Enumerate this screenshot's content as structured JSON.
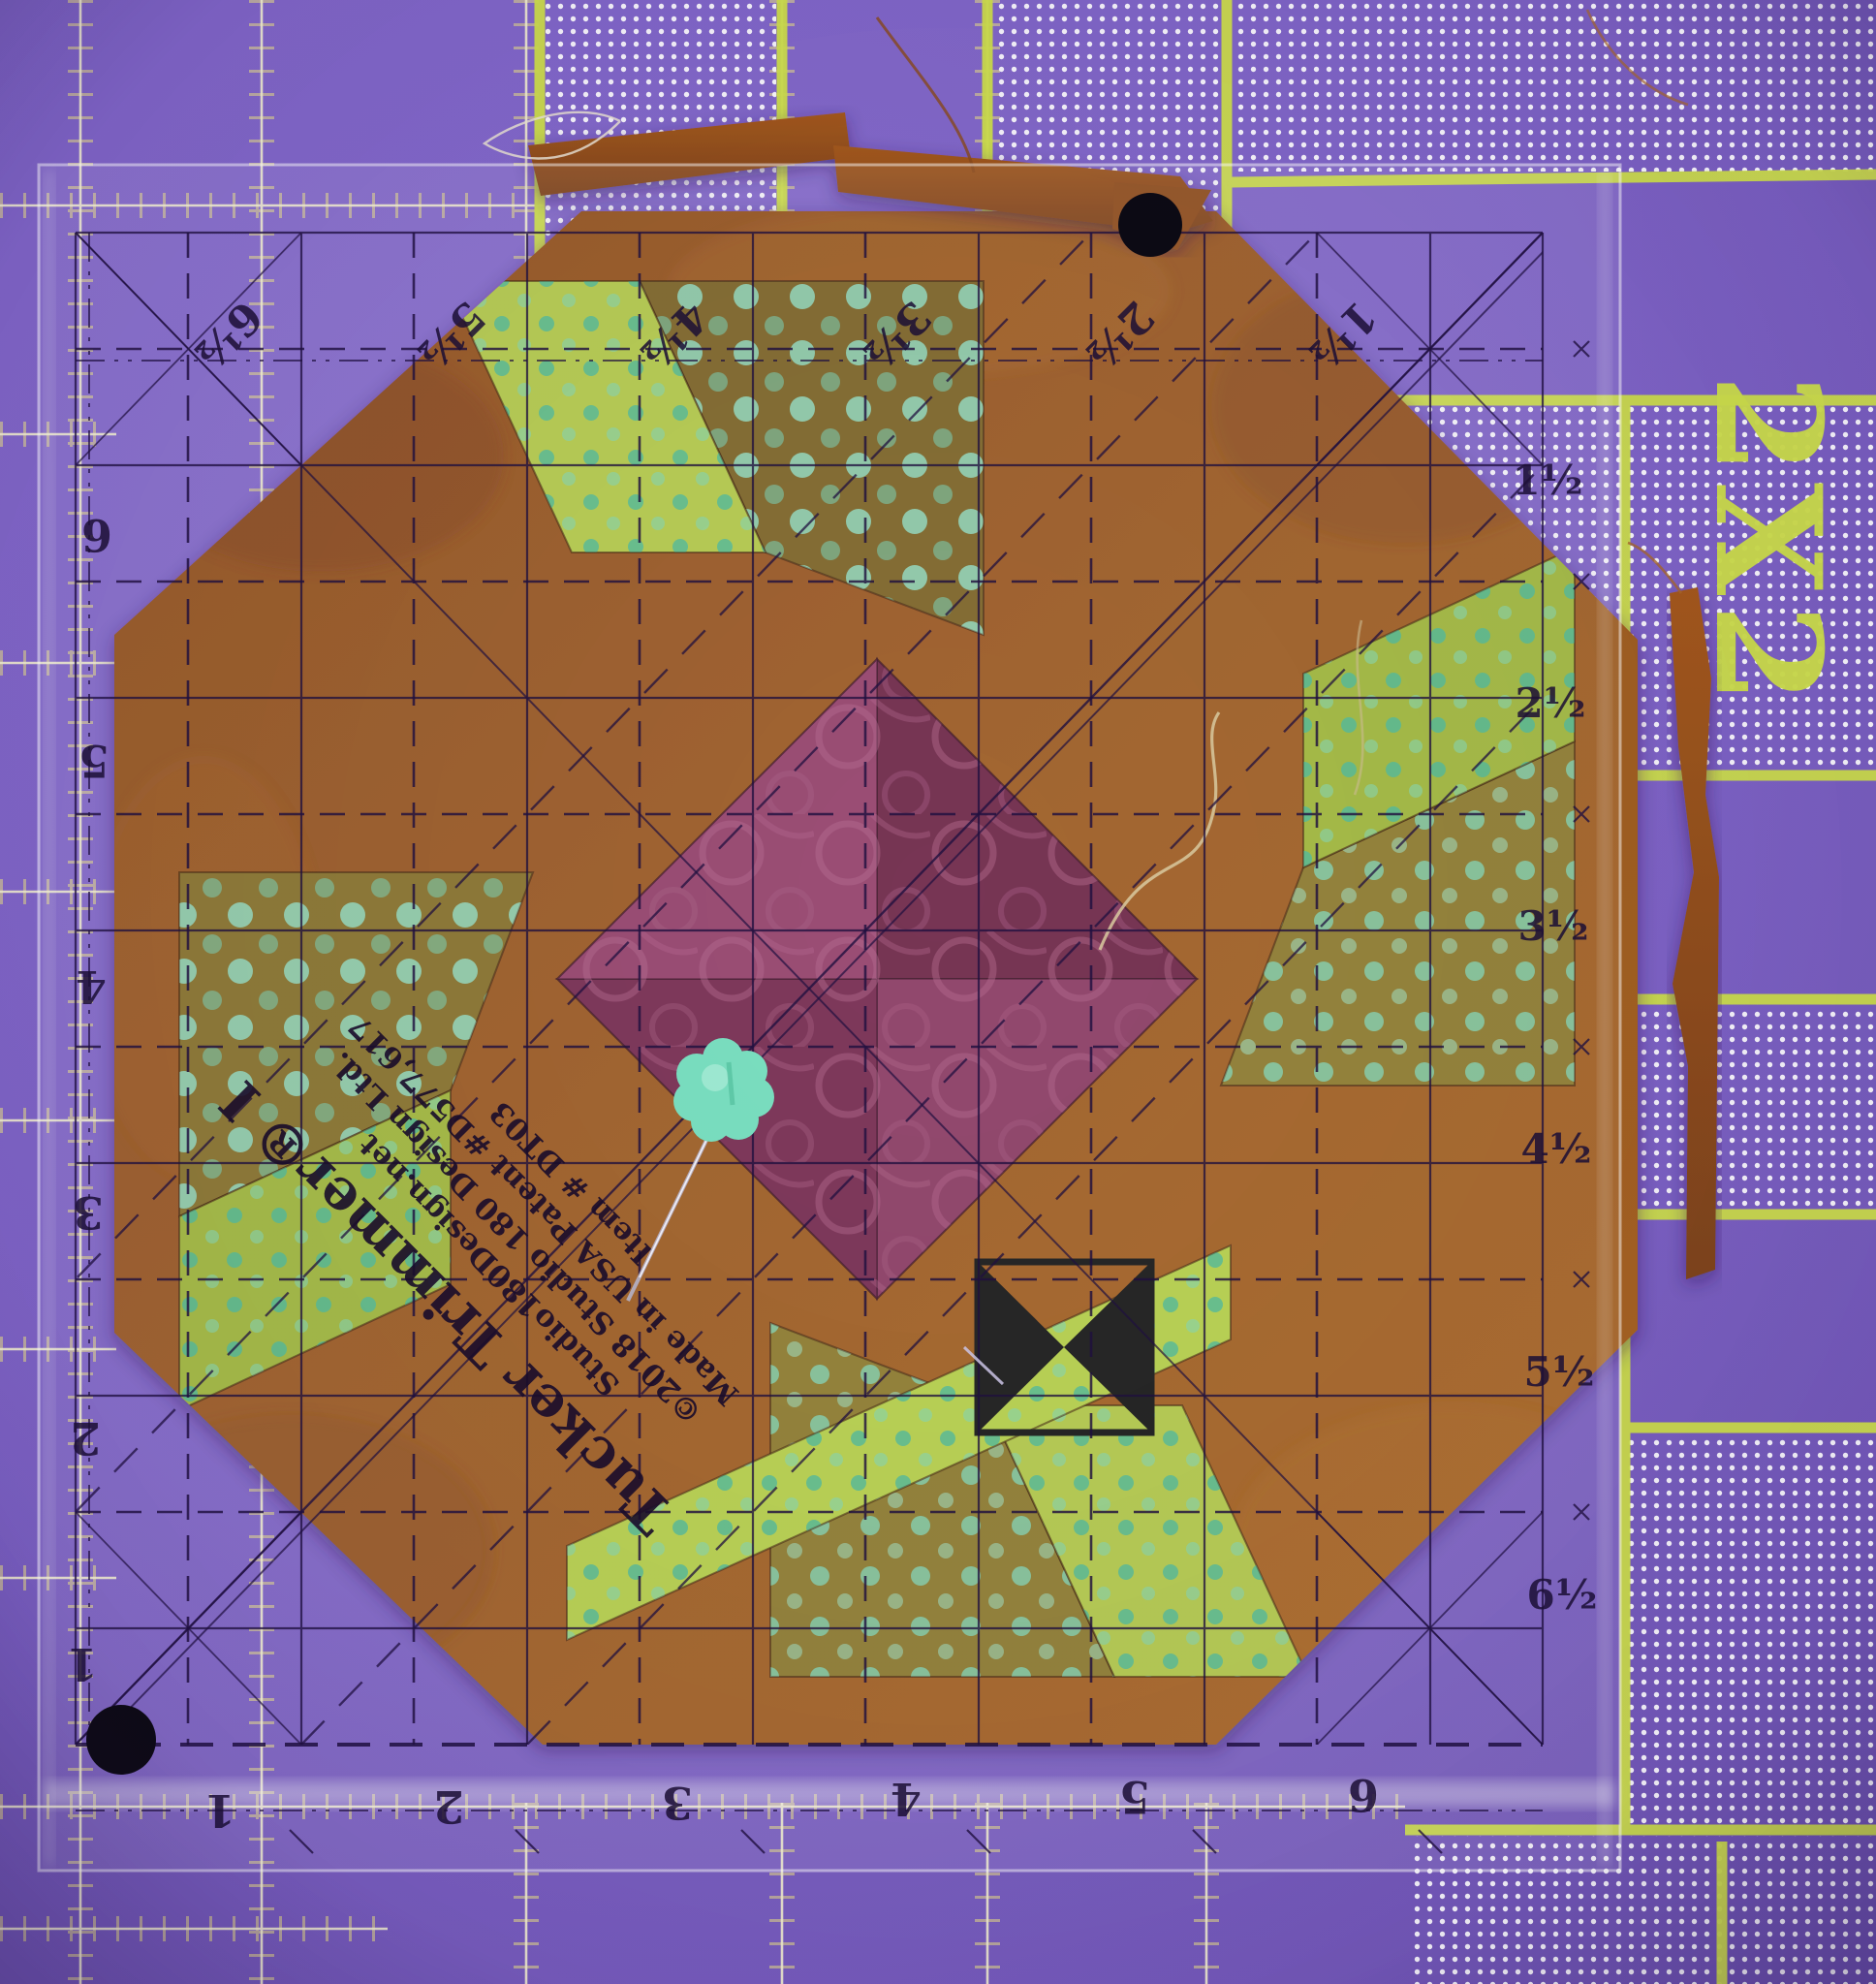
{
  "mat": {
    "label_2x2": "2X2",
    "purple": "#7e63c6",
    "chartreuse": "#cdde4b",
    "dot_color": "#ffffff",
    "grid_line_color": "#f2eecf",
    "tick_color": "#ece285"
  },
  "ruler": {
    "brand": {
      "title": "Tucker Trimmer® I",
      "line1": "Studio180Design.net",
      "line2": "©2018 Studio 180 Design Ltd.",
      "line3": "Made in USA    Patent #D577,617",
      "line4": "Item # DT03"
    },
    "top_labels": [
      "6½",
      "5½",
      "4½",
      "3½",
      "2½",
      "1½"
    ],
    "right_labels": [
      "1½",
      "2½",
      "3½",
      "4½",
      "5½",
      "6½"
    ],
    "left_labels": [
      "6",
      "5",
      "4",
      "3",
      "2",
      "1"
    ],
    "bottom_labels": [
      "1",
      "2",
      "3",
      "4",
      "5",
      "6"
    ],
    "ink_color": "#1c0f35"
  },
  "block": {
    "colors": {
      "rust": "#9b5a23",
      "rust_dark": "#82471a",
      "chartreuse_fabric": "#aabf3f",
      "olive_fabric": "#8d7a2e",
      "dark_olive_fabric": "#7b6428",
      "plum_dark": "#6d2547",
      "plum": "#8a3a63",
      "teal_dot": "#49b896",
      "hourglass_black": "#141414"
    }
  },
  "pin": {
    "head_color": "#7adfc0",
    "shaft_color": "#e8e8f0"
  }
}
